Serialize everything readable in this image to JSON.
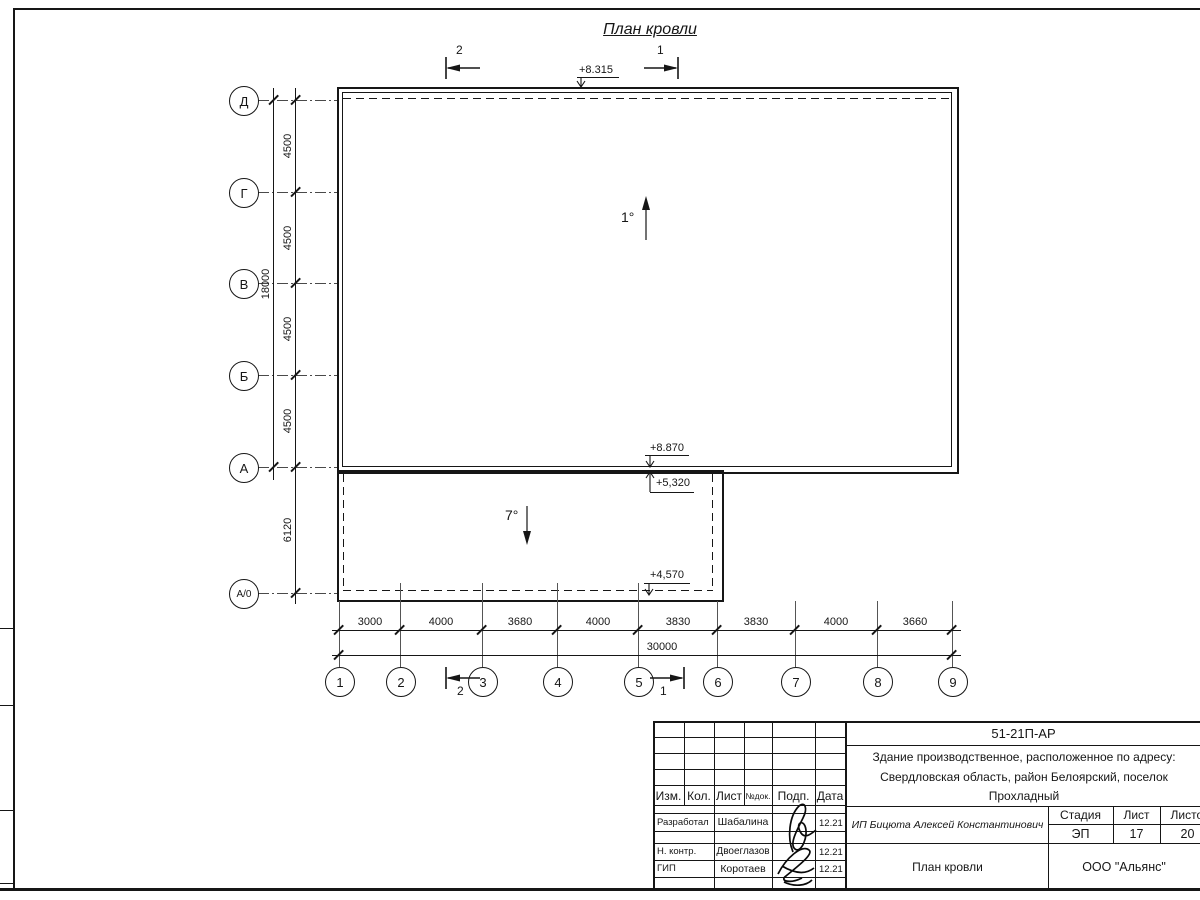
{
  "drawing": {
    "title": "План кровли",
    "slopes": {
      "main": "1°",
      "annex": "7°"
    },
    "elevations": {
      "ridge_top": "+8.315",
      "main_edge": "+8.870",
      "annex_top": "+5,320",
      "annex_edge": "+4,570"
    },
    "sections": {
      "left": "2",
      "right": "1"
    },
    "vertical_axes": {
      "labels": [
        "Д",
        "Г",
        "В",
        "Б",
        "А",
        "А/0"
      ],
      "spans": [
        "4500",
        "4500",
        "4500",
        "4500"
      ],
      "total": "18000",
      "annex_span": "6120"
    },
    "horizontal_axes": {
      "labels": [
        "1",
        "2",
        "3",
        "4",
        "5",
        "6",
        "7",
        "8",
        "9"
      ],
      "spans": [
        "3000",
        "4000",
        "3680",
        "4000",
        "3830",
        "3830",
        "4000",
        "3660"
      ],
      "total": "30000"
    }
  },
  "titleblock": {
    "code": "51-21П-АР",
    "object_lines": [
      "Здание производственное, расположенное по адресу:",
      "Свердловская область, район Белоярский, поселок",
      "Прохладный"
    ],
    "client": "ИП Бицюта Алексей Константинович",
    "sheet_name": "План кровли",
    "org": "ООО \"Альянс\"",
    "headers": {
      "izm": "Изм.",
      "kol": "Кол.",
      "list": "Лист",
      "ndok": "№док.",
      "podp": "Подп.",
      "data": "Дата",
      "stage": "Стадия",
      "sheet": "Лист",
      "sheets": "Листов"
    },
    "stage": "ЭП",
    "sheet_no": "17",
    "sheets_total": "20",
    "people": [
      {
        "role": "Разработал",
        "name": "Шабалина",
        "date": "12.21"
      },
      {
        "role": "Н. контр.",
        "name": "Двоеглазов",
        "date": "12.21"
      },
      {
        "role": "ГИП",
        "name": "Коротаев",
        "date": "12.21"
      }
    ]
  }
}
